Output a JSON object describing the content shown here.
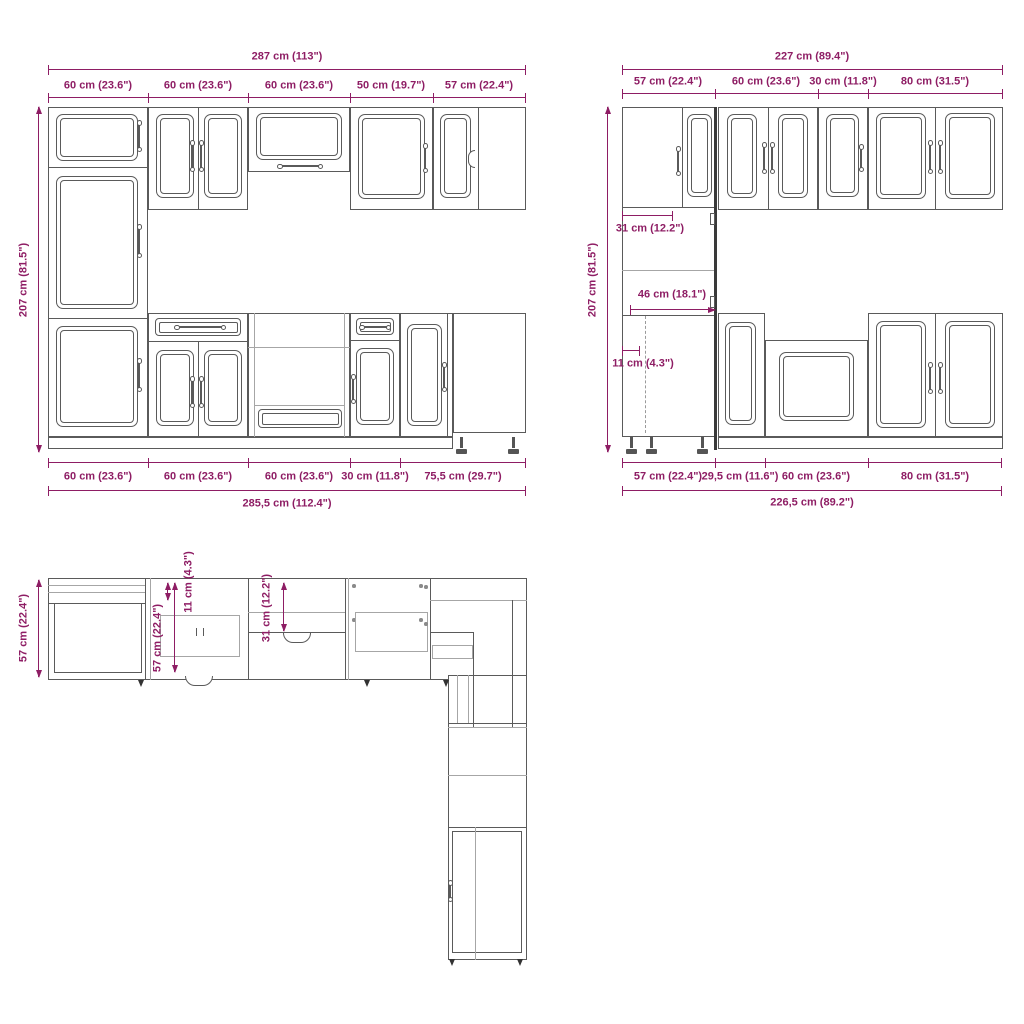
{
  "colors": {
    "dimension": "#8e1d64",
    "line": "#5a5a5a",
    "background": "#ffffff"
  },
  "front_left": {
    "total_top": "287 cm (113\")",
    "segments_top": [
      "60 cm (23.6\")",
      "60 cm (23.6\")",
      "60 cm (23.6\")",
      "50 cm (19.7\")",
      "57 cm (22.4\")"
    ],
    "height": "207 cm (81.5\")",
    "segments_bottom": [
      "60 cm (23.6\")",
      "60 cm (23.6\")",
      "60 cm (23.6\")",
      "30 cm (11.8\")",
      "75,5 cm (29.7\")"
    ],
    "total_bottom": "285,5 cm (112.4\")"
  },
  "front_right": {
    "total_top": "227 cm (89.4\")",
    "segments_top": [
      "57 cm (22.4\")",
      "60 cm (23.6\")",
      "30 cm (11.8\")",
      "80 cm (31.5\")"
    ],
    "height": "207 cm (81.5\")",
    "upper_depth": "31 cm (12.2\")",
    "counter_depth": "46 cm (18.1\")",
    "plinth_inset": "11 cm (4.3\")",
    "segments_bottom": [
      "57 cm (22.4\")",
      "29,5 cm (11.6\")",
      "60 cm (23.6\")",
      "80 cm (31.5\")"
    ],
    "total_bottom": "226,5 cm (89.2\")"
  },
  "plan": {
    "depth_left": "57 cm (22.4\")",
    "inner_depth": "57 cm (22.4\")",
    "front_inset": "11 cm (4.3\")",
    "wall_depth": "31 cm (12.2\")"
  }
}
